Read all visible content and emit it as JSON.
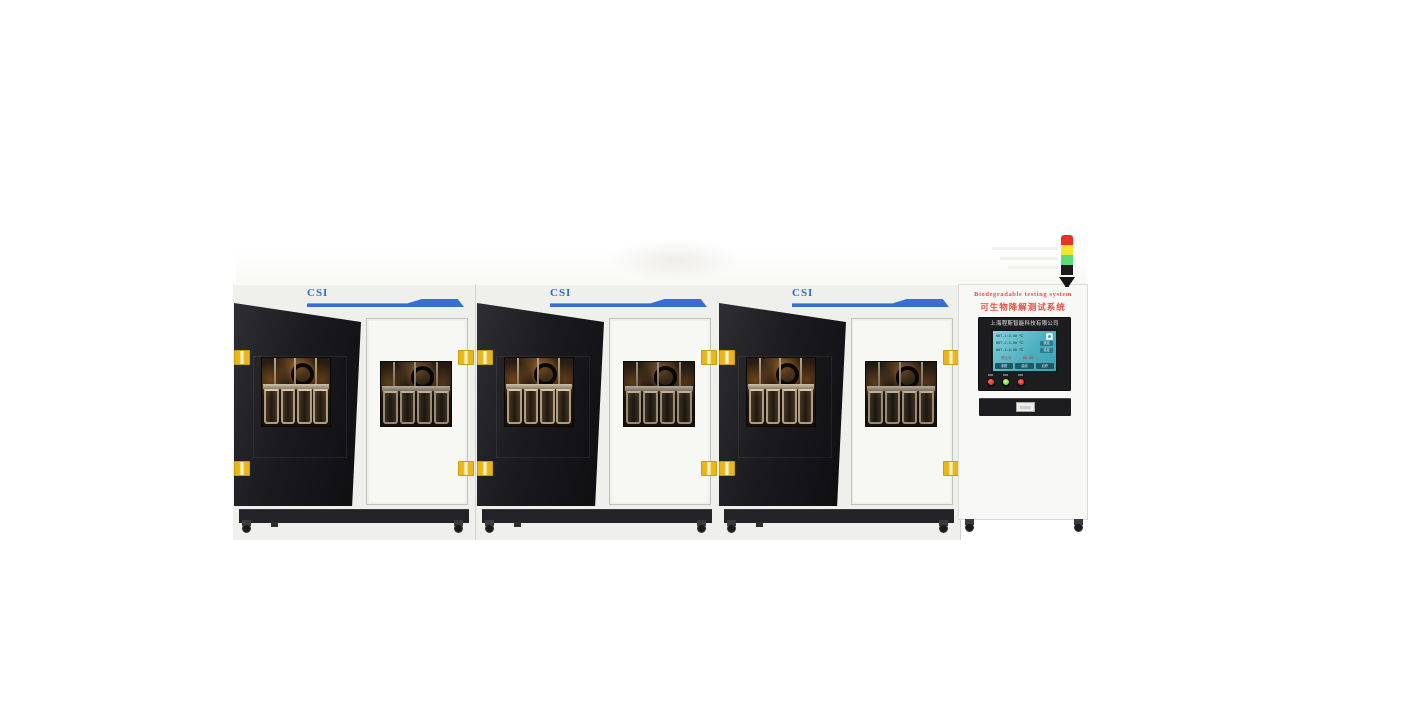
{
  "titles": {
    "en": "Biodegradable testing system",
    "zh": "可生物降解测试系统"
  },
  "company": {
    "name": "上海程斯智能科技有限公司"
  },
  "units": [
    {
      "brand": "CSI"
    },
    {
      "brand": "CSI"
    },
    {
      "brand": "CSI"
    }
  ],
  "control": {
    "screen": {
      "row1_left": "NBT-1:0.00 ℃",
      "row1_right": "CSI",
      "row2_left": "NBT-2:0.00 ℃",
      "row2_button": "设定",
      "row3_left": "NBT-3:0.00 ℃",
      "row3_button": "设定",
      "status_left": "停止中",
      "status_right": "00:00",
      "bottom_buttons": [
        "参数",
        "曲线",
        "启停"
      ]
    },
    "push_buttons": [
      {
        "name": "stop-button",
        "color": "#d41f16"
      },
      {
        "name": "run-button",
        "color": "#6ecb28"
      },
      {
        "name": "power-button",
        "color": "#d41f16"
      }
    ]
  },
  "tower": {
    "segments": [
      "#e8312a",
      "#f2e52c",
      "#5ddb7a",
      "#1c1c1e"
    ]
  },
  "colors": {
    "accent_blue": "#376fd4",
    "title_red": "#e85048",
    "latch_yellow": "#e9b61a"
  }
}
